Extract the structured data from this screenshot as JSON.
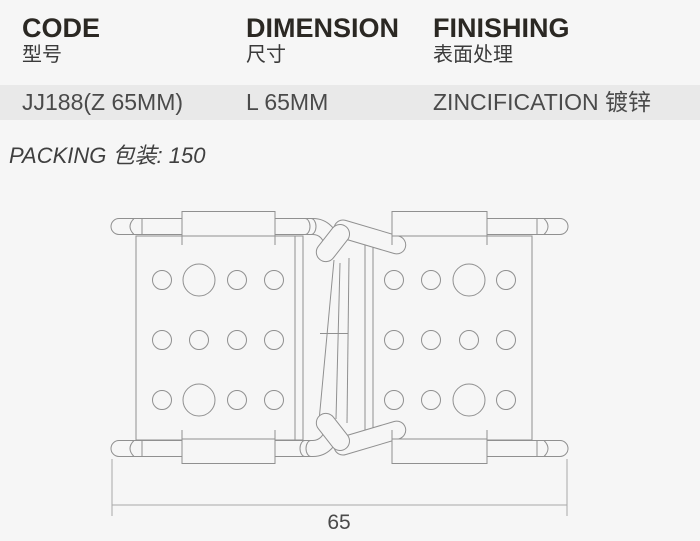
{
  "table": {
    "columns": [
      {
        "en": "CODE",
        "zh": "型号"
      },
      {
        "en": "DIMENSION",
        "zh": "尺寸"
      },
      {
        "en": "FINISHING",
        "zh": "表面处理"
      }
    ],
    "row": {
      "code": "JJ188(Z 65MM)",
      "dimension": "L 65MM",
      "finishing": "ZINCIFICATION 镀锌"
    },
    "row_stripe_color": "#e9e9e9"
  },
  "packing": "PACKING 包装: 150",
  "drawing": {
    "dim_label": "65",
    "line_color": "#909090",
    "dim_line_color": "#a8a8a8"
  },
  "colors": {
    "page_bg": "#f6f6f6",
    "heading_text": "#2b2823",
    "body_text": "#4a4a4a"
  }
}
